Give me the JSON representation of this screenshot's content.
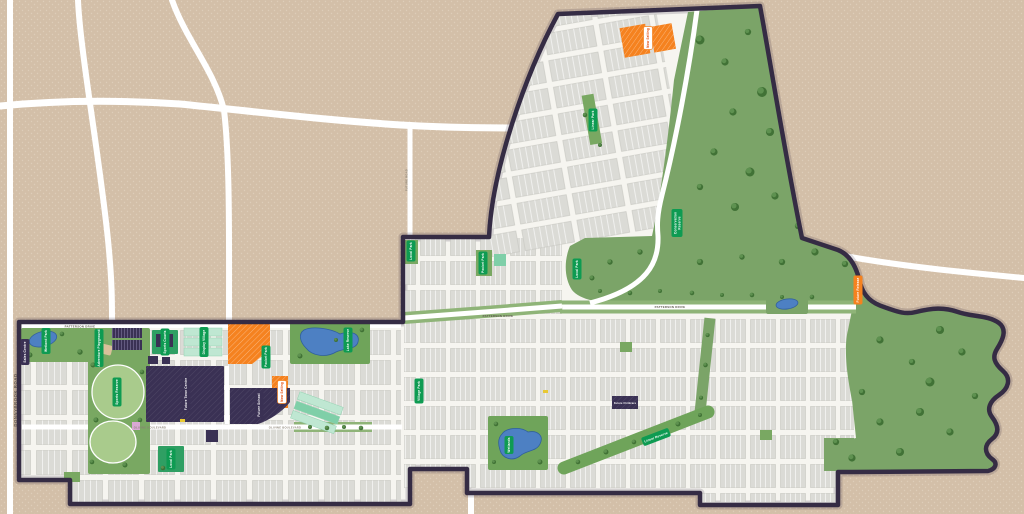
{
  "map": {
    "road_labels": {
      "donnybrook_road": "DONNYBROOK ROAD",
      "future_road": "FUTURE ROAD",
      "patterson_drive_w": "PATTERSON DRIVE",
      "patterson_drive_mid": "PATTERSON DRIVE",
      "patterson_drive_e": "PATTERSON DRIVE",
      "olivine_boulevard_w": "OLIVINE BOULEVARD",
      "olivine_boulevard_e": "OLIVINE BOULEVARD"
    },
    "park_labels": {
      "wetland_park": "Wetland Park",
      "adventure_playground": "Adventure Playground",
      "sports_courts": "Sports Courts",
      "sports_reserve": "Sports Reserve",
      "display_village": "Display Village",
      "pocket_park_a": "Pocket Park",
      "pocket_park_b": "Pocket Park",
      "lake_reserve": "Lake Reserve",
      "local_park_nw": "Local Park",
      "local_park_mid": "Local Park",
      "local_park_s": "Local Park",
      "linear_park": "Linear Park",
      "linear_reserve": "Linear Reserve",
      "village_park": "Village Park",
      "wetlands_south": "Wetlands",
      "conservation_line1": "Conservation",
      "conservation_line2": "Reserve"
    },
    "site_labels": {
      "sales_centre": "Sales Centre",
      "future_town_centre": "Future Town Centre",
      "future_school": "Future School",
      "future_childcare": "Future Childcare"
    },
    "status_labels": {
      "now_selling_north": "Now Selling",
      "now_selling_west": "Now Selling",
      "future_release_east": "Future Release"
    },
    "colors": {
      "tan_background": "#D3BFA8",
      "boundary_navy": "#352C44",
      "lot_gray": "#DBDBD6",
      "park_green": "#79A862",
      "conservation_green": "#7BA468",
      "pill_green": "#0E9B52",
      "navy_block": "#3A3154",
      "highlight_orange": "#F5821F",
      "pond_blue": "#4D80C3",
      "mint": "#BFE7D2",
      "road_white": "#FFFFFF"
    }
  }
}
